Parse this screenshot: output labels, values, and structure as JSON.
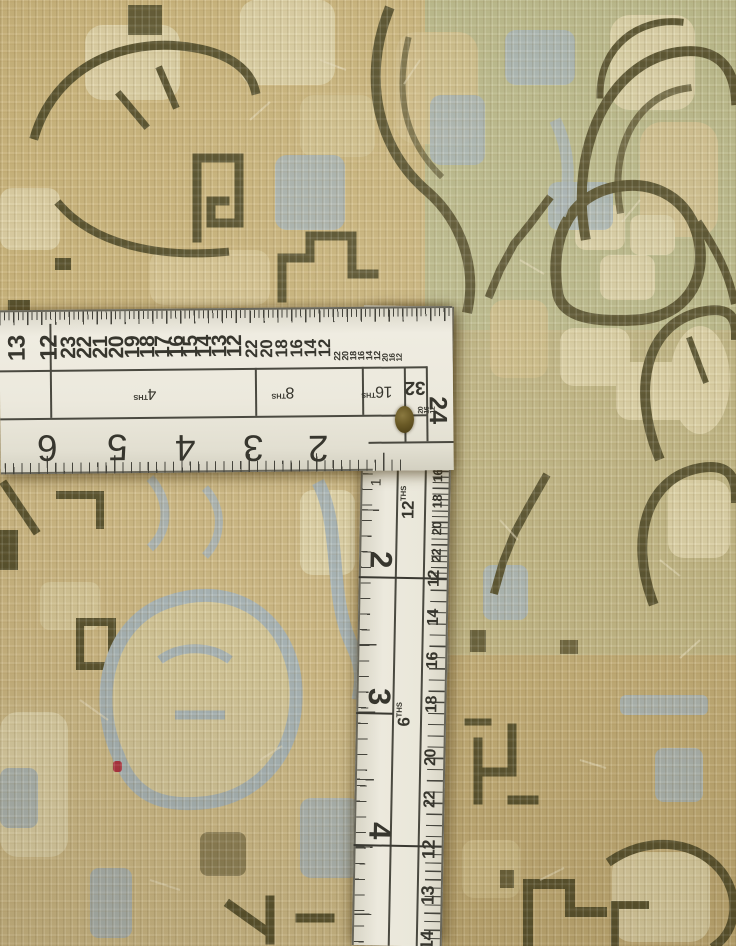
{
  "scene": {
    "description": "Close-up photograph of a hand-knotted tan and sage Oushak-style rug with an L-shaped steel framing square (carpenter's square) lying on it",
    "objects": [
      "rug",
      "framing-square-ruler",
      "brass-rivet",
      "red-thread"
    ]
  },
  "palette": {
    "rug_tan": "#c8b37c",
    "rug_wheat": "#d7c794",
    "rug_cream": "#e2d7ad",
    "rug_sage": "#bcbb8c",
    "rug_blue": "#a9b6b9",
    "rug_dark": "#57512d",
    "ruler_face": "#ece9dd",
    "ruler_ink": "#3c3b33",
    "rivet": "#6a5a26",
    "red_thread": "#b03040"
  },
  "ruler": {
    "horizontal": {
      "edge_numbers": [
        {
          "t": "13",
          "x": 18,
          "y": 38,
          "s": 24
        },
        {
          "t": "12",
          "x": 50,
          "y": 38,
          "s": 24
        },
        {
          "t": "23",
          "x": 69,
          "y": 38,
          "s": 21
        },
        {
          "t": "22",
          "x": 85,
          "y": 38,
          "s": 21
        },
        {
          "t": "21",
          "x": 101,
          "y": 38,
          "s": 21
        },
        {
          "t": "20",
          "x": 117,
          "y": 38,
          "s": 21
        },
        {
          "t": "19",
          "x": 133,
          "y": 38,
          "s": 21
        },
        {
          "t": "18",
          "x": 148,
          "y": 38,
          "s": 21
        },
        {
          "t": "17",
          "x": 163,
          "y": 38,
          "s": 21
        },
        {
          "t": "16",
          "x": 177,
          "y": 38,
          "s": 21
        },
        {
          "t": "15",
          "x": 191,
          "y": 38,
          "s": 21
        },
        {
          "t": "14",
          "x": 205,
          "y": 38,
          "s": 21
        },
        {
          "t": "13",
          "x": 220,
          "y": 38,
          "s": 21
        },
        {
          "t": "12",
          "x": 235,
          "y": 38,
          "s": 21
        },
        {
          "t": "22",
          "x": 252,
          "y": 41,
          "s": 17
        },
        {
          "t": "20",
          "x": 267,
          "y": 41,
          "s": 17
        },
        {
          "t": "18",
          "x": 282,
          "y": 41,
          "s": 17
        },
        {
          "t": "16",
          "x": 297,
          "y": 41,
          "s": 17
        },
        {
          "t": "14",
          "x": 311,
          "y": 41,
          "s": 17
        },
        {
          "t": "12",
          "x": 325,
          "y": 41,
          "s": 17
        },
        {
          "t": "22",
          "x": 338,
          "y": 49,
          "s": 9
        },
        {
          "t": "20",
          "x": 346,
          "y": 49,
          "s": 9
        },
        {
          "t": "18",
          "x": 354,
          "y": 49,
          "s": 9
        },
        {
          "t": "16",
          "x": 362,
          "y": 49,
          "s": 9
        },
        {
          "t": "14",
          "x": 370,
          "y": 49,
          "s": 9
        },
        {
          "t": "12",
          "x": 378,
          "y": 49,
          "s": 9
        },
        {
          "t": "20",
          "x": 386,
          "y": 51,
          "s": 8
        },
        {
          "t": "16",
          "x": 393,
          "y": 51,
          "s": 8
        },
        {
          "t": "12",
          "x": 400,
          "y": 51,
          "s": 8
        },
        {
          "t": "20",
          "x": 421,
          "y": 104,
          "s": 7
        },
        {
          "t": "16",
          "x": 427,
          "y": 104,
          "s": 7
        },
        {
          "t": "12",
          "x": 433,
          "y": 104,
          "s": 7
        }
      ],
      "band_labels": [
        {
          "t": "4",
          "sub": "THS",
          "x": 152,
          "y": 84
        },
        {
          "t": "8",
          "sub": "THS",
          "x": 290,
          "y": 84
        },
        {
          "t": "16",
          "sub": "THS",
          "x": 384,
          "y": 84
        }
      ],
      "box_label": "32",
      "corner_number": "24",
      "inch_numbers": [
        {
          "t": "6",
          "x": 47,
          "y": 138
        },
        {
          "t": "5",
          "x": 117,
          "y": 138
        },
        {
          "t": "4",
          "x": 185,
          "y": 139
        },
        {
          "t": "3",
          "x": 253,
          "y": 140
        },
        {
          "t": "2",
          "x": 318,
          "y": 141
        }
      ]
    },
    "vertical": {
      "inch_one": "1",
      "ths_labels": [
        {
          "t": "12",
          "sub": "THS",
          "x": 48,
          "y": 204
        },
        {
          "t": "6",
          "sub": "THS",
          "x": 48,
          "y": 416
        }
      ],
      "inch_numbers": [
        {
          "t": "2",
          "x": 22,
          "y": 254
        },
        {
          "t": "3",
          "x": 23,
          "y": 391
        },
        {
          "t": "4",
          "x": 26,
          "y": 525
        }
      ],
      "edge_numbers": [
        {
          "t": "12",
          "x": 78,
          "y": 74,
          "s": 10
        },
        {
          "t": "16",
          "x": 78,
          "y": 88,
          "s": 10
        },
        {
          "t": "20",
          "x": 78,
          "y": 102,
          "s": 10
        },
        {
          "t": "12",
          "x": 77,
          "y": 119,
          "s": 13
        },
        {
          "t": "14",
          "x": 77,
          "y": 144,
          "s": 13
        },
        {
          "t": "16",
          "x": 77,
          "y": 169,
          "s": 13
        },
        {
          "t": "18",
          "x": 77,
          "y": 195,
          "s": 13
        },
        {
          "t": "20",
          "x": 77,
          "y": 222,
          "s": 13
        },
        {
          "t": "22",
          "x": 77,
          "y": 249,
          "s": 13
        },
        {
          "t": "12",
          "x": 76,
          "y": 272,
          "s": 16
        },
        {
          "t": "14",
          "x": 76,
          "y": 311,
          "s": 16
        },
        {
          "t": "16",
          "x": 76,
          "y": 354,
          "s": 16
        },
        {
          "t": "18",
          "x": 76,
          "y": 398,
          "s": 16
        },
        {
          "t": "20",
          "x": 76,
          "y": 451,
          "s": 16
        },
        {
          "t": "22",
          "x": 76,
          "y": 493,
          "s": 16
        },
        {
          "t": "12",
          "x": 75,
          "y": 543,
          "s": 18
        },
        {
          "t": "13",
          "x": 75,
          "y": 589,
          "s": 18
        },
        {
          "t": "14",
          "x": 75,
          "y": 634,
          "s": 18
        }
      ]
    }
  }
}
